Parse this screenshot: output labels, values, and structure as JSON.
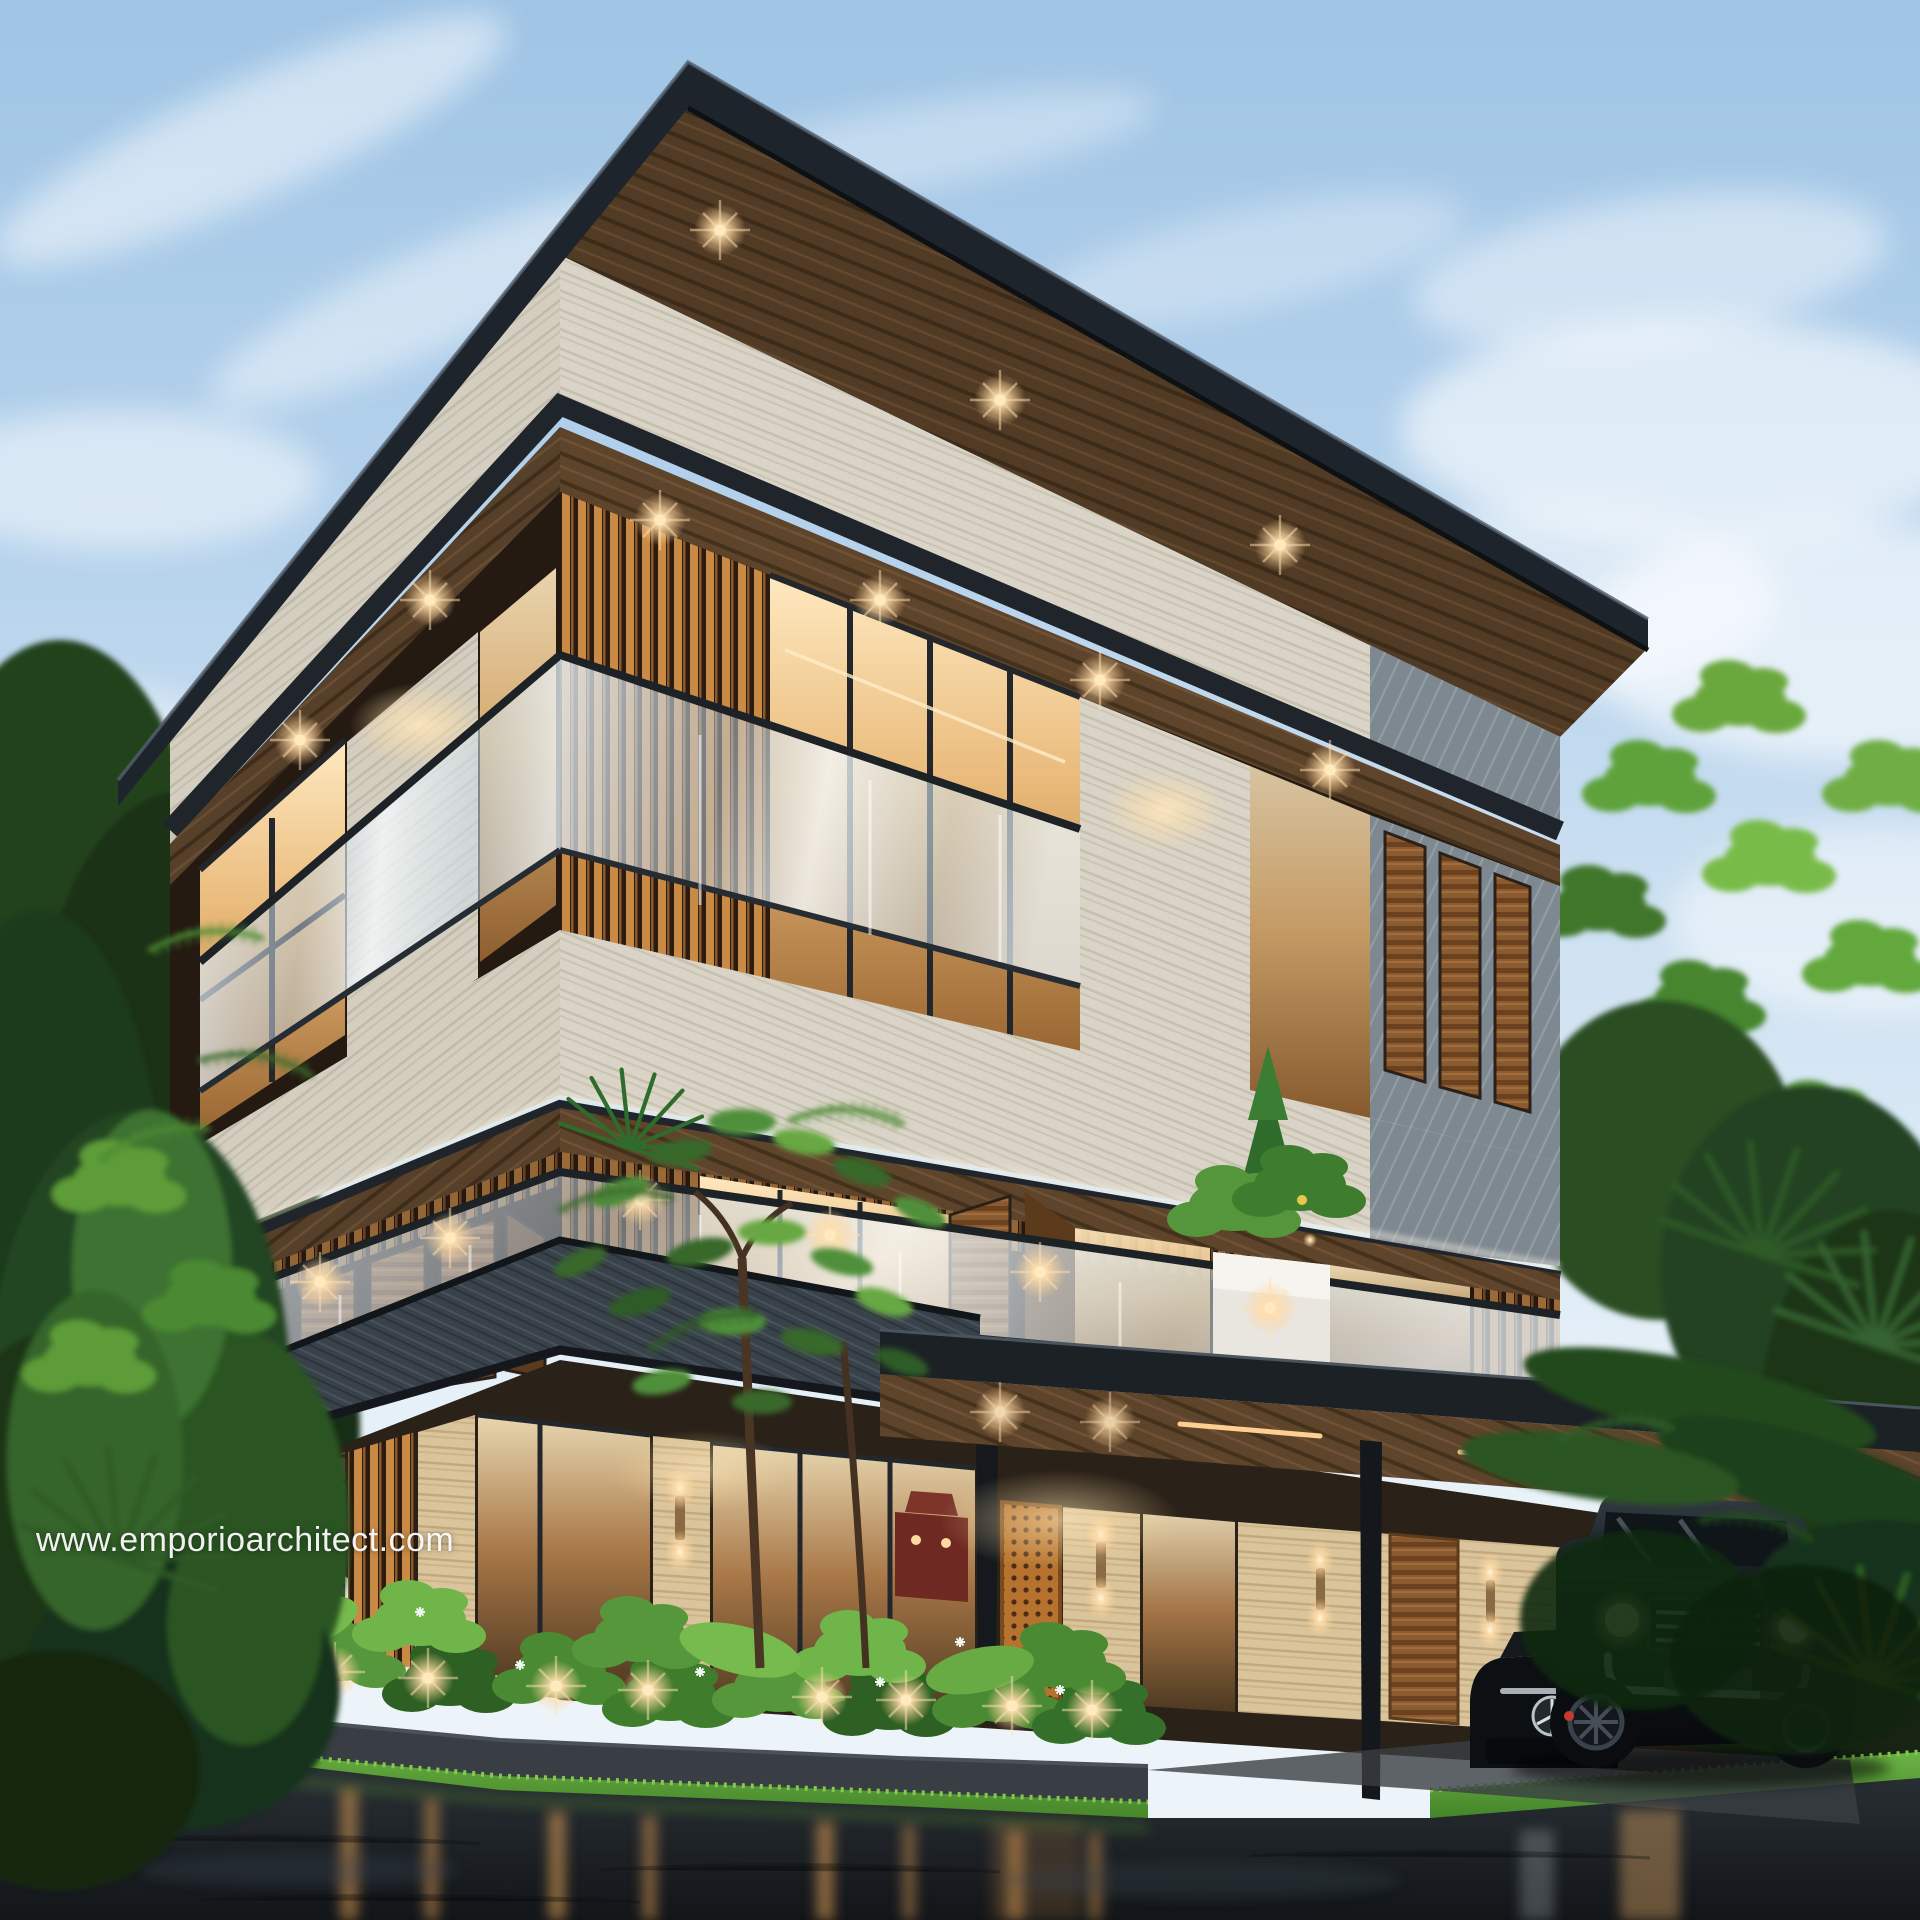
{
  "watermark": {
    "text": "www.emporioarchitect.com",
    "color": "#ffffff",
    "position": "left-middle"
  },
  "scene": {
    "type": "architectural-exterior-render",
    "time_of_day": "dusk",
    "ground_condition": "wet pavement with warm light reflections",
    "building": {
      "storeys": 3,
      "style": "modern tropical villa, corner perspective",
      "features": [
        "dark flat overhanging roof",
        "wood plank soffits with recessed warm downlights",
        "white travertine fascia bands",
        "frameless glass balcony railings",
        "wooden pivot shutters",
        "amber backlit vertical slat screens",
        "gray slate-clad slab band",
        "stone rubble wall",
        "perforated orange lattice entrance door",
        "travertine pillars with wall sconces",
        "carport canopy with linear LED strips",
        "balcony planter with shrubs"
      ]
    },
    "landscape": [
      "tall tropical trees on both sides",
      "fan palms",
      "delicate flame tree in front of facade",
      "dense shrub planter with garden uplights and white flowers",
      "bright green grass strip"
    ],
    "vehicles": {
      "suv": "black luxury boxy SUV with chrome grille, round headlights and bull bar",
      "sedan": "dark sedan nose with three-pointed star emblem"
    },
    "sky": "pale blue dusk sky with soft clouds"
  },
  "palette": {
    "sky_top": "#9fc4e5",
    "sky_low": "#e9f2f8",
    "roof_dark": "#1e242b",
    "wood_soffit": "#5e442b",
    "travertine": "#d9d4c7",
    "slate_band": "#39424a",
    "glass_tint": "#cfe0ea",
    "window_warm": "#ffe9c0",
    "shutter_wood": "#8a5a30",
    "foliage_bright": "#6fb546",
    "foliage_dark": "#1f3a1c",
    "grass": "#5aa336",
    "asphalt": "#1b2025",
    "light_glow": "#ffd9a0",
    "car_black": "#0a0d10"
  }
}
